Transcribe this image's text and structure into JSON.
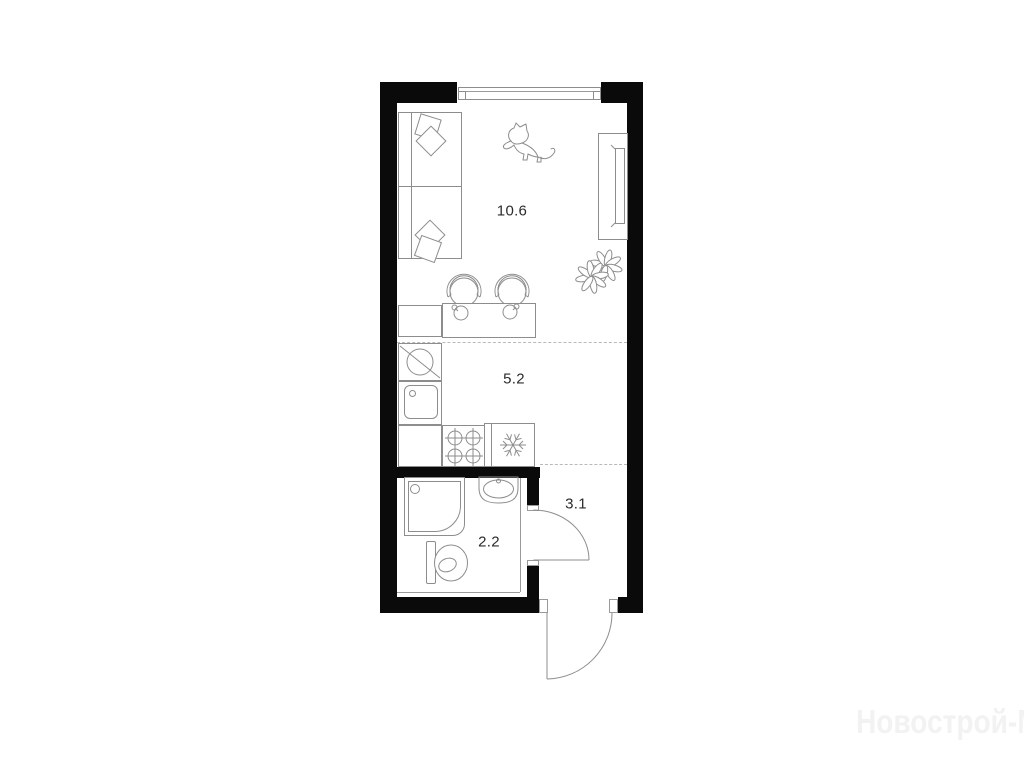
{
  "floorplan": {
    "rooms": [
      {
        "id": "living-room",
        "area_label": "10.6"
      },
      {
        "id": "kitchen",
        "area_label": "5.2"
      },
      {
        "id": "hallway",
        "area_label": "3.1"
      },
      {
        "id": "bathroom",
        "area_label": "2.2"
      }
    ],
    "watermark": "Новострой-М",
    "fixtures": [
      "sofa",
      "pillows",
      "cat",
      "tv-unit",
      "plant",
      "chairs",
      "dining-table",
      "kitchen-counter",
      "washing-machine",
      "kitchen-sink",
      "stove",
      "fridge",
      "shower-cabin",
      "washbasin",
      "toilet",
      "window",
      "bathroom-door",
      "entrance-door"
    ],
    "colors": {
      "wall": "#0a0a0a",
      "furniture_line": "#8d8d8d",
      "label_text": "#2b2b2b",
      "dashed_zone_line": "#b9b9b9",
      "watermark": "#f2f2f2",
      "background": "#ffffff"
    }
  }
}
